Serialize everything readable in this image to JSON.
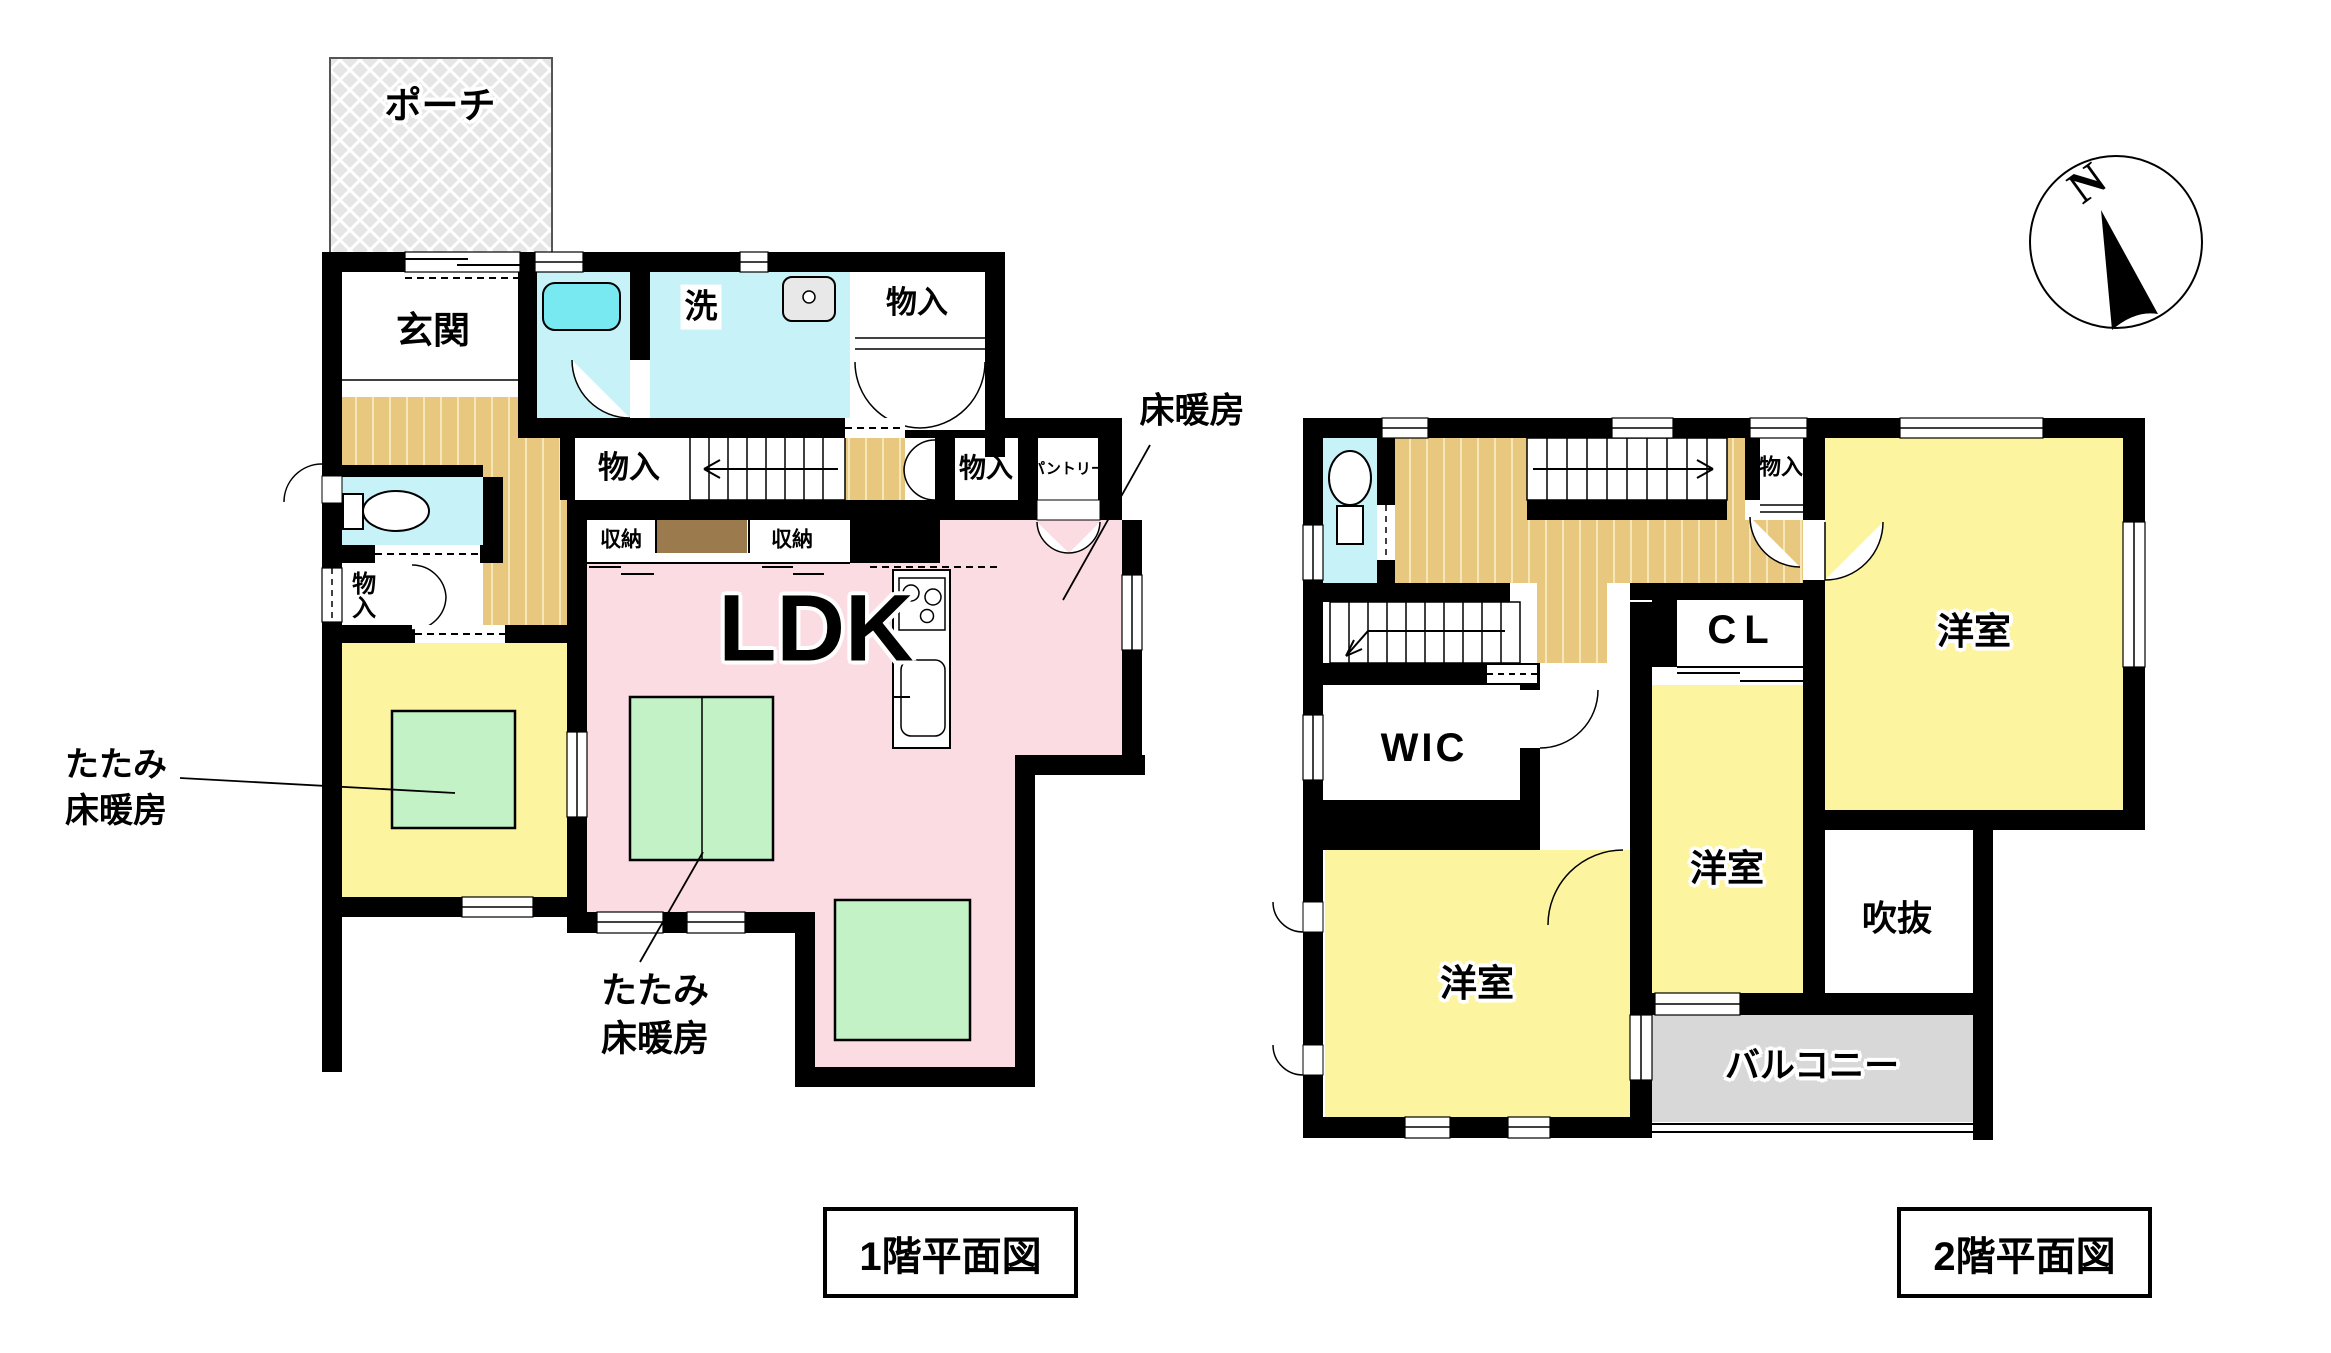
{
  "meta": {
    "type": "floor-plan",
    "background": "#ffffff"
  },
  "colors": {
    "wall": "#000000",
    "room_pink": "#fbdce2",
    "room_yellow": "#fcf49e",
    "room_cyan": "#c7f2f8",
    "tub_cyan": "#79e9f1",
    "tatami_green": "#c2f2c6",
    "wood_floor": "#e8c87e",
    "porch_gray": "#e6e6e6",
    "balcony_gray": "#d8d8d8",
    "cabinet_brown": "#9b7a4e"
  },
  "compass": {
    "north": "N"
  },
  "floor1": {
    "title": "1階平面図",
    "rooms": {
      "porch": "ポーチ",
      "entrance": "玄関",
      "laundry": "洗",
      "storage_top": "物入",
      "storage_hall": "物入",
      "storage_side": "物入",
      "storage_kitchen": "物入",
      "pantry": "パントリー",
      "closet_a": "収納",
      "closet_b": "収納",
      "ldk": "LDK",
      "floor_heating": "床暖房",
      "tatami_left_1": "たたみ",
      "tatami_left_2": "床暖房",
      "tatami_right_1": "たたみ",
      "tatami_right_2": "床暖房"
    }
  },
  "floor2": {
    "title": "2階平面図",
    "rooms": {
      "storage": "物入",
      "closet": "CL",
      "walk_in_closet": "WIC",
      "bedroom_top": "洋室",
      "bedroom_center": "洋室",
      "bedroom_left": "洋室",
      "void": "吹抜",
      "balcony": "バルコニー"
    }
  }
}
